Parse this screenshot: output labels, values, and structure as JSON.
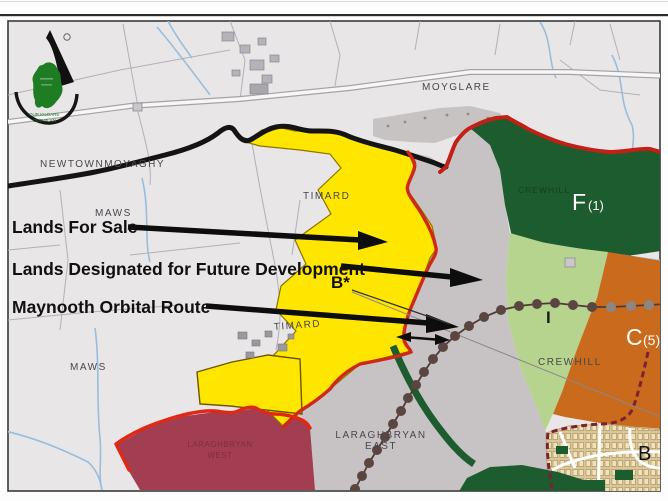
{
  "annotations": {
    "lands_for_sale": "Lands For Sale",
    "future_development": "Lands Designated for Future Development",
    "orbital_route": "Maynooth Orbital Route",
    "b_star": "B*"
  },
  "zone_labels": {
    "f_letter": "F",
    "f_sub": "(1)",
    "c_letter": "C",
    "c_sub": "(5)",
    "i_label": "I",
    "b_label": "B"
  },
  "townlands": {
    "newtownmoyaghy": "NEWTOWNMOYAGHY",
    "moyglare": "MOYGLARE",
    "timard_north": "TIMARD",
    "timard_south": "TIMARD",
    "maws_north": "MAWS",
    "maws_south": "MAWS",
    "laraghbryan_east_1": "LARAGHBRYAN",
    "laraghbryan_east_2": "EAST",
    "laraghbryan_west_1": "LARAGHBRYAN",
    "laraghbryan_west_2": "WEST",
    "crewhill": "CREWHILL",
    "crewhill_watermark": "CREWHILL"
  },
  "logo": {
    "tagline_1": "OUR KILDARE",
    "tagline_2": "OUR PLAN"
  },
  "colors": {
    "lands_for_sale_yellow": "#ffe600",
    "future_development_grey": "#c7c3c5",
    "amenity_dark_green": "#1d5c2e",
    "open_space_light_green": "#b7d48e",
    "commercial_orange": "#c96a1c",
    "residential_maroon": "#a23d52",
    "built_up_tan": "#d8c79a",
    "boundary_red": "#cf2815",
    "route_dot_brown": "#5a4540"
  }
}
